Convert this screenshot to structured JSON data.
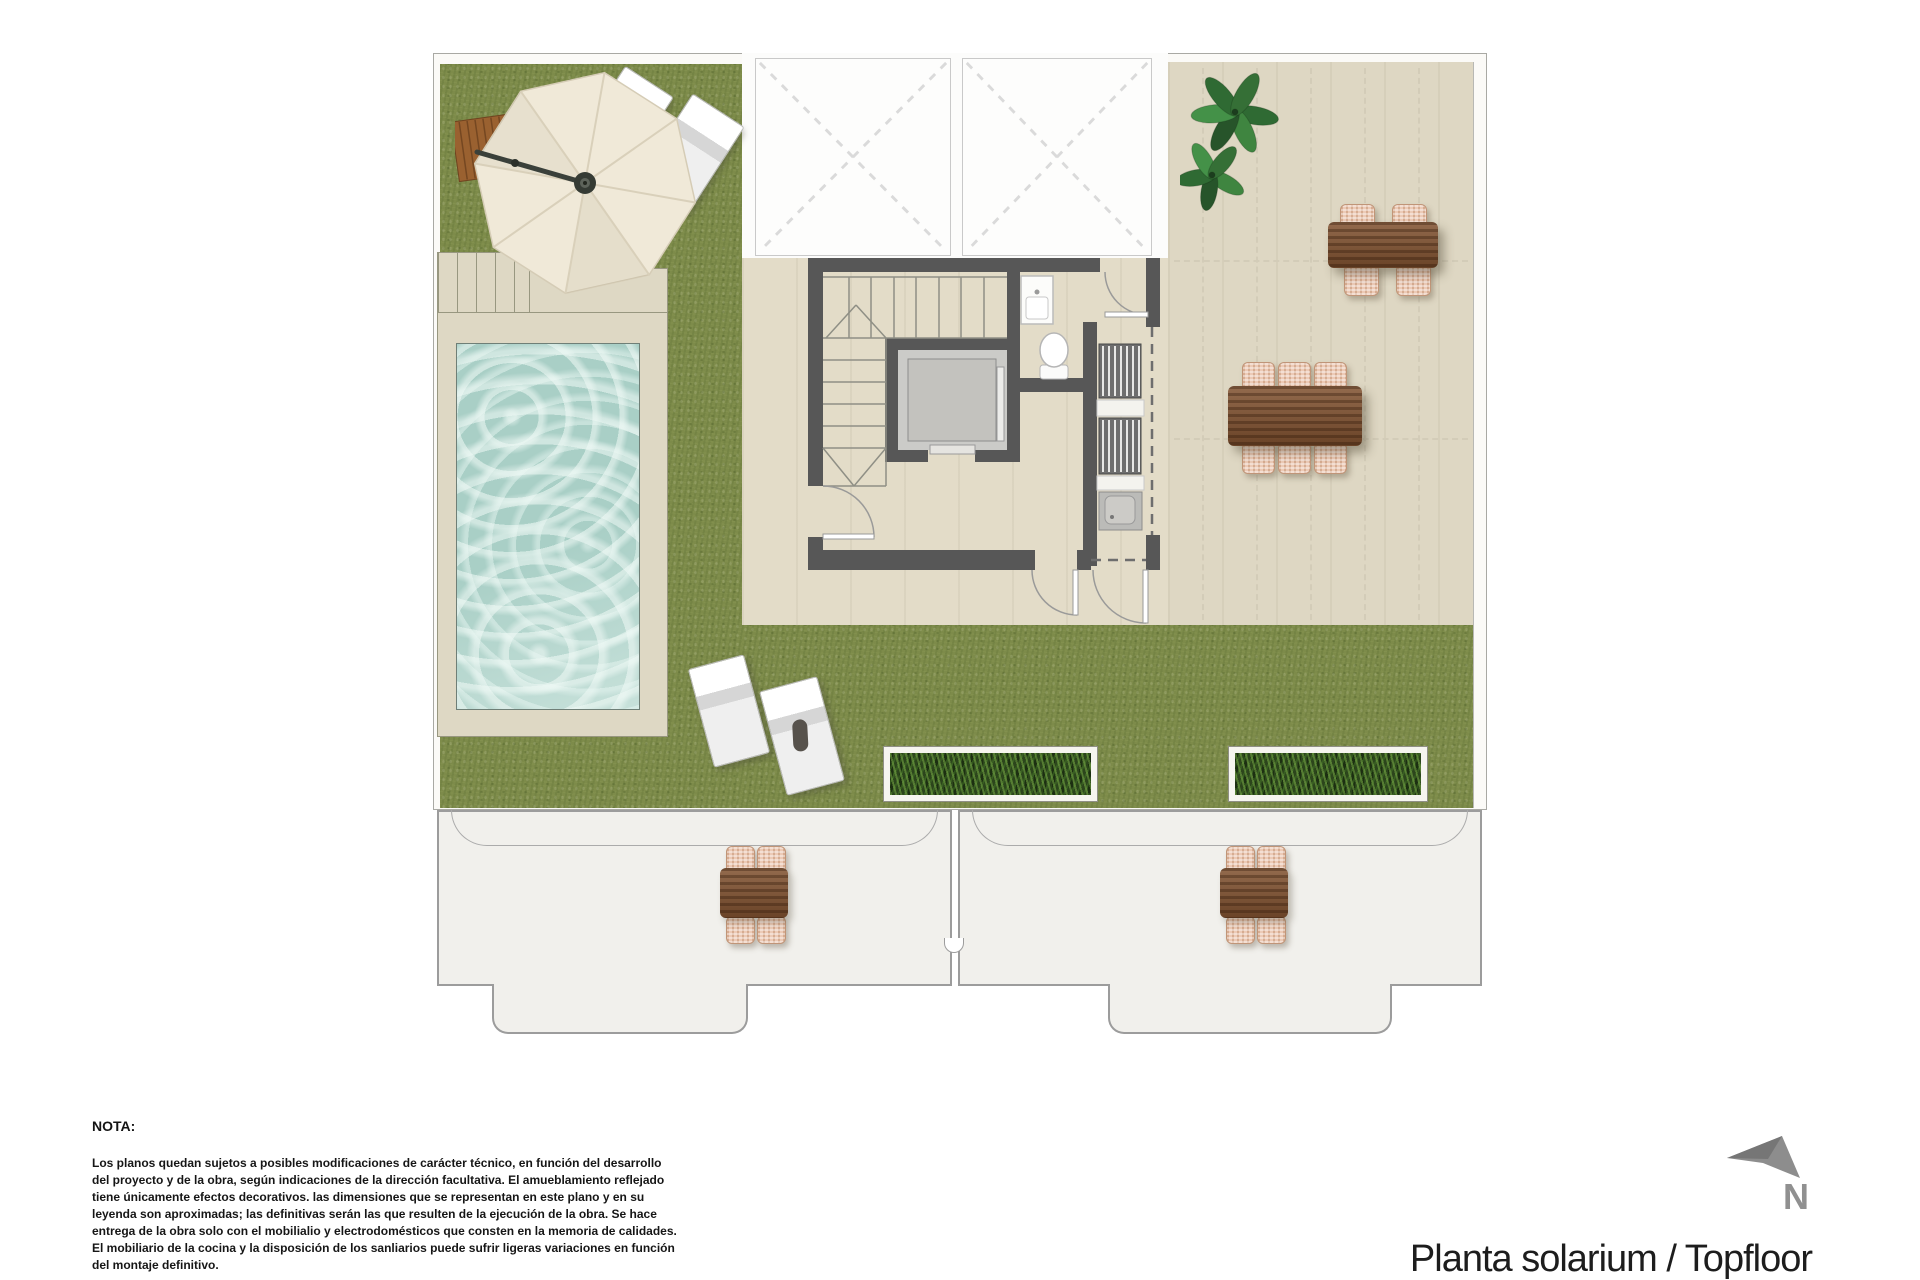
{
  "plan": {
    "title": "Planta solarium / Topfloor",
    "compass": {
      "label": "N"
    },
    "visible_items": [
      "artificial-grass-lawn",
      "private-pool",
      "pool-deck-with-steps",
      "parasol-umbrella",
      "sun-loungers",
      "stair-core-with-elevator",
      "toilet",
      "washbasin-cabinet",
      "utility-closet-with-louvered-units",
      "skylight-voids",
      "roof-terrace-pergola",
      "dining-table-6-seats",
      "dining-table-4-seats",
      "planters",
      "plant",
      "lower-floor-terraces-with-tables",
      "north-arrow"
    ]
  },
  "notes": {
    "heading": "NOTA:",
    "lines": [
      "Los planos quedan sujetos a posibles modificaciones de carácter técnico, en función del desarrollo",
      "del proyecto y de la obra, según indicaciones de la dirección facultativa. El amueblamiento reflejado",
      "tiene únicamente efectos decorativos. las dimensiones que se representan en este plano y en su",
      "leyenda son aproximadas; las definitivas serán las que resulten de la ejecución de la obra. Se hace",
      "entrega de la obra solo con el mobilialio y electrodomésticos que consten en la memoria de calidades.",
      "El mobiliario de la cocina y la disposición de los sanliarios puede sufrir ligeras variaciones en función",
      "del montaje definitivo."
    ]
  },
  "colors": {
    "grass": "#7d8b4a",
    "paving": "#ded7c3",
    "core_floor": "#e3dcc8",
    "wall": "#575757",
    "water": "#a9cfc6",
    "deck": "#ded8c4",
    "wood": "#815230",
    "wicker": "#eccab6",
    "planter_green": "#2c451c",
    "lower_floor": "#f1f0ec",
    "title_text": "#1d1d1d",
    "north_gray": "#8d8d8d"
  }
}
